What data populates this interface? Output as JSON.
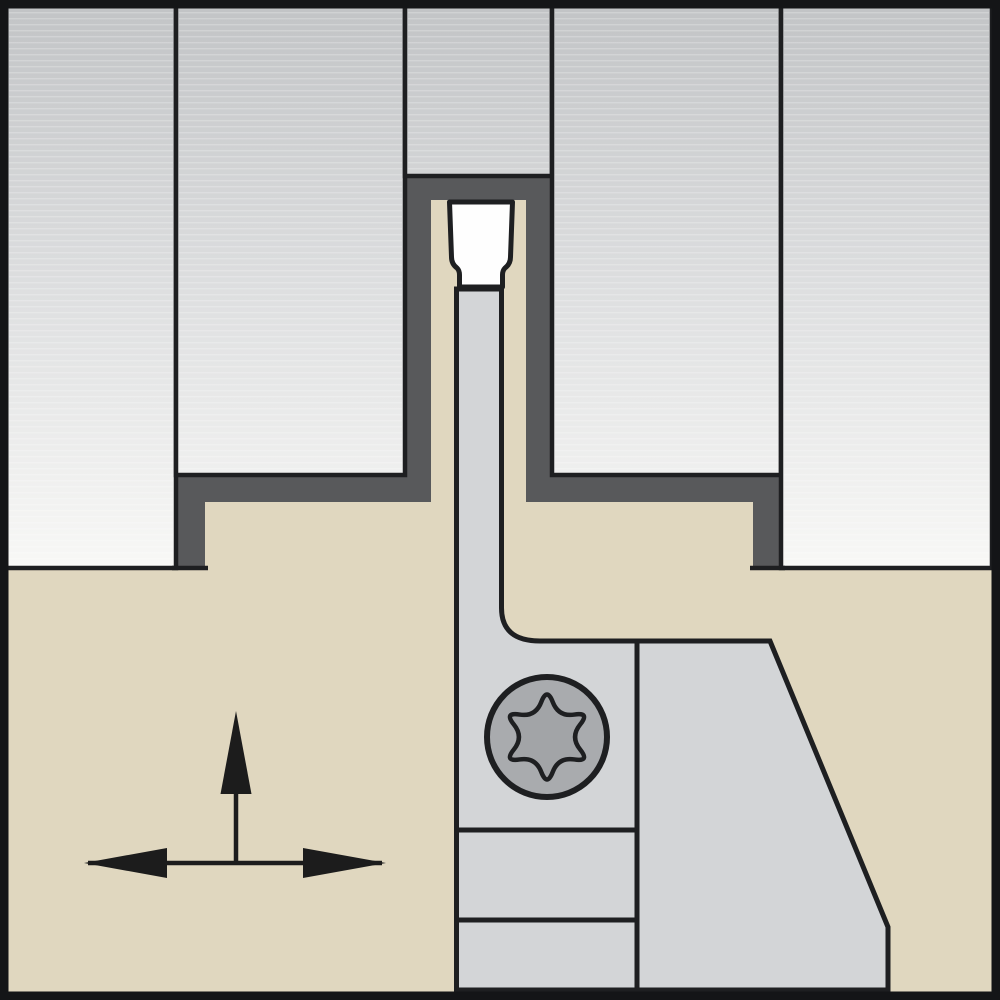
{
  "diagram": {
    "kind": "technical-illustration",
    "subject": "grooving-tool-holder-cross-section",
    "parts": {
      "workpiece": "workpiece-slabs",
      "groove": "machined-groove-face",
      "holder": "tool-holder-body",
      "blade": "parting-blade",
      "clamp": "clamp-block",
      "insert": "cutting-insert",
      "screw": "torx-screw-icon",
      "arrows": "feed-direction-arrows-icon"
    },
    "arrow_directions": [
      "up",
      "left",
      "right"
    ]
  },
  "colors": {
    "outline": "#1E1F21",
    "frame": "#141517",
    "workpiece_top": "#C2C4C6",
    "workpiece_mid": "#E0E1E2",
    "workpiece_bottom": "#F8F8F6",
    "groove_face": "#58595B",
    "holder_tan": "#E0D7BF",
    "blade_gray": "#D3D5D7",
    "insert_white": "#FEFEFE",
    "screw_head": "#A9ABAE",
    "screw_star": "#A2A4A7",
    "arrow_black": "#1C1C1C",
    "texture_line": "#FFFFFF"
  }
}
